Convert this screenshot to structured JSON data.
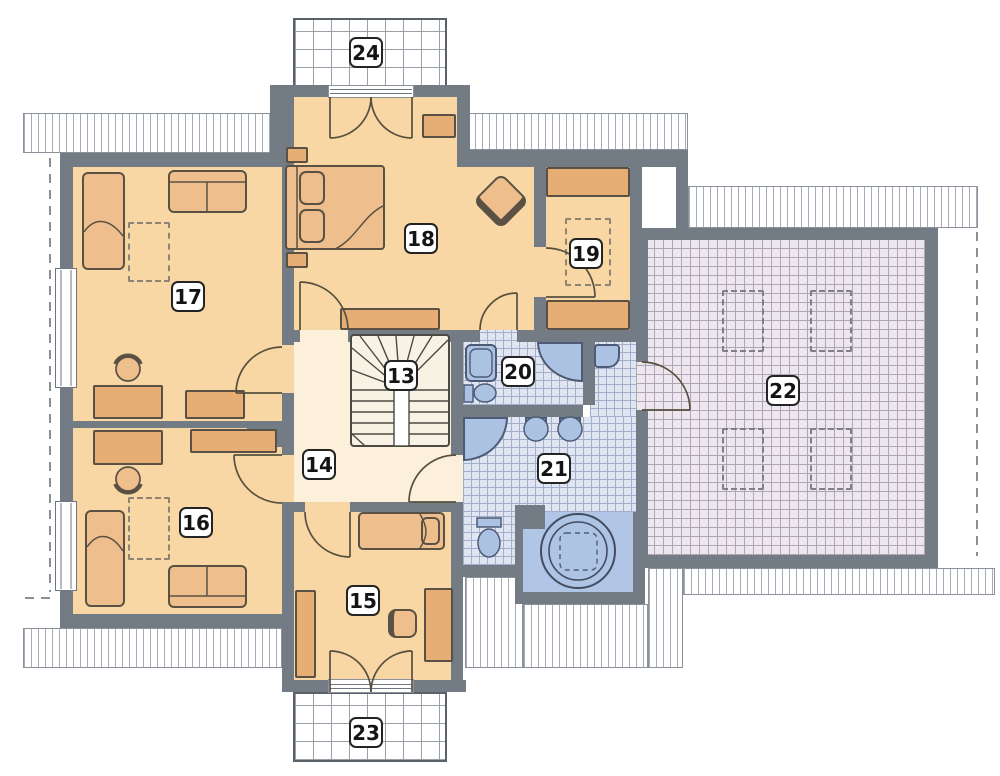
{
  "plan_title": "Upper floor plan",
  "labels": {
    "r13": "13",
    "r14": "14",
    "r15": "15",
    "r16": "16",
    "r17": "17",
    "r18": "18",
    "r19": "19",
    "r20": "20",
    "r21": "21",
    "r22": "22",
    "r23": "23",
    "r24": "24"
  },
  "colors": {
    "wall": "#737b85",
    "room_floor": "#f8d7a5",
    "hall_floor": "#fcf0da",
    "furniture": "#eebe8c",
    "furniture_dark": "#e6ad74",
    "bath_tile": "#e0e6f1",
    "bath_fixture": "#abc2e3",
    "attic_floor": "#ece6ef",
    "alcove": "#b1c5e6",
    "label_border": "#242424"
  }
}
